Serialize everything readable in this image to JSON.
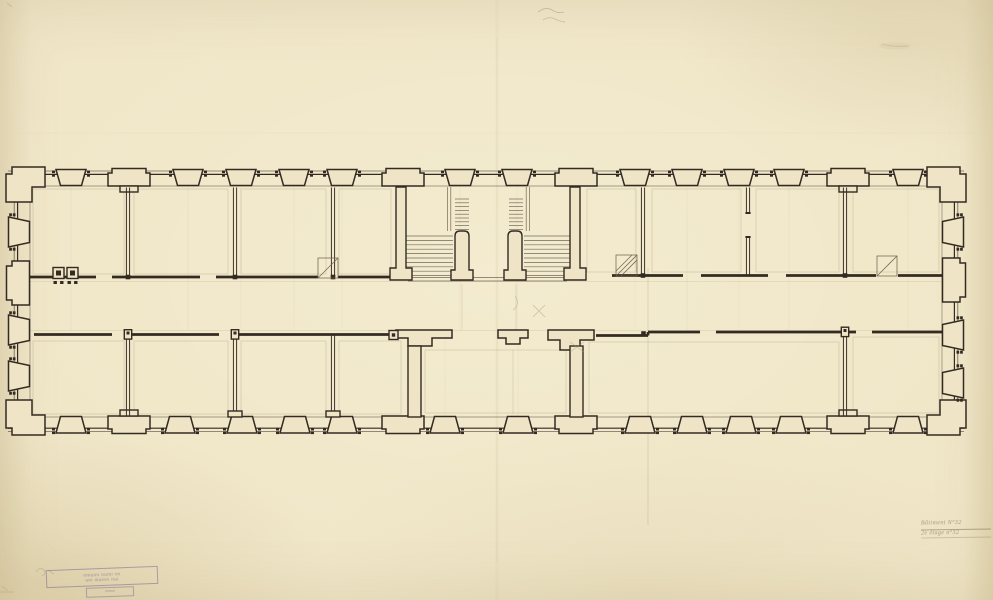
{
  "document": {
    "kind": "scanned architectural floor plan, ink on aged paper",
    "annotation": {
      "line1": "Bâtiment N°32",
      "line2": "2e étage n°32"
    },
    "stamp": {
      "line1": "nmuini numi im",
      "line2": "uni muinn nui",
      "sub": "nmnui"
    }
  },
  "colors": {
    "paper": "#efe5c6",
    "ink": "#332b22",
    "ink_light": "#5b5243",
    "pencil": "#a4936f",
    "stamp": "#70608e"
  },
  "plan": {
    "top_window_piers": [
      71,
      188,
      241,
      294,
      342,
      460,
      517,
      635,
      687,
      739,
      789,
      908
    ],
    "top_big_piers": [
      129,
      403,
      576,
      848
    ],
    "bottom_window_piers": [
      71,
      180,
      242,
      295,
      342,
      445,
      518,
      640,
      692,
      741,
      791,
      908
    ],
    "bottom_big_piers": [
      129,
      403,
      576,
      848
    ],
    "left_window_piers": [
      232,
      330,
      376
    ],
    "left_big_piers": [
      283
    ],
    "right_window_piers": [
      232,
      335,
      383
    ],
    "right_big_piers": [
      280
    ],
    "upper_partitions": [
      {
        "x": 128
      },
      {
        "x": 235
      },
      {
        "x": 333
      },
      {
        "x": 643
      },
      {
        "x": 748,
        "door": [
          214,
          236
        ]
      },
      {
        "x": 845
      }
    ],
    "lower_partitions": [
      {
        "x": 128
      },
      {
        "x": 235
      },
      {
        "x": 333
      },
      {
        "x": 845
      }
    ],
    "corridor_walls": [
      {
        "y": 277.0,
        "segments": [
          [
            30,
            96
          ],
          [
            112,
            200
          ],
          [
            216,
            318
          ],
          [
            338,
            391
          ]
        ]
      },
      {
        "y": 275.5,
        "segments": [
          [
            612,
            683
          ],
          [
            701,
            768
          ],
          [
            786,
            876
          ],
          [
            898,
            943
          ]
        ]
      },
      {
        "y": 334.5,
        "segments": [
          [
            34,
            112
          ],
          [
            126,
            219
          ],
          [
            233,
            389
          ]
        ]
      },
      {
        "y": 332.0,
        "segments": [
          [
            648,
            700
          ],
          [
            716,
            856
          ],
          [
            872,
            943
          ]
        ]
      },
      {
        "y": 335.5,
        "segments": [
          [
            596,
            648
          ]
        ]
      }
    ],
    "junction_squares": [
      [
        128,
        277
      ],
      [
        235,
        277
      ],
      [
        333,
        277
      ],
      [
        643,
        275.5
      ],
      [
        845,
        275.5
      ],
      [
        128,
        334.5
      ],
      [
        235,
        334.5
      ],
      [
        845,
        332
      ],
      [
        643.5,
        333.5
      ]
    ],
    "pier_blocks": [
      {
        "x": 128,
        "y": 334.5
      },
      {
        "x": 235,
        "y": 334.5
      },
      {
        "x": 845,
        "y": 332
      }
    ],
    "chimneys": [
      58.5,
      72.5
    ],
    "door_swings": [
      {
        "x": 318,
        "y": 258,
        "s": 20
      },
      {
        "x": 616,
        "y": 255,
        "s": 21,
        "hatch": true
      },
      {
        "x": 877,
        "y": 256,
        "s": 20
      }
    ],
    "partition_stubs_bottom": [
      235,
      333
    ],
    "rooms": [
      [
        30,
        186,
        97,
        91
      ],
      [
        131,
        186,
        100,
        91
      ],
      [
        238,
        186,
        91,
        91
      ],
      [
        336,
        186,
        58,
        91
      ],
      [
        584,
        186,
        55,
        89
      ],
      [
        649,
        186,
        95,
        89
      ],
      [
        753,
        186,
        89,
        89
      ],
      [
        850,
        186,
        92,
        89
      ],
      [
        30,
        338,
        97,
        79
      ],
      [
        131,
        338,
        100,
        79
      ],
      [
        238,
        338,
        91,
        79
      ],
      [
        336,
        338,
        68,
        79
      ],
      [
        422,
        347,
        147,
        69
      ],
      [
        586,
        339,
        256,
        77
      ],
      [
        850,
        334,
        92,
        82
      ]
    ],
    "pencil_axes_top": [
      71,
      188,
      241,
      294,
      342,
      460,
      517,
      635,
      687,
      739,
      789,
      908
    ],
    "pencil_axes_bottom": [
      445,
      518
    ]
  }
}
